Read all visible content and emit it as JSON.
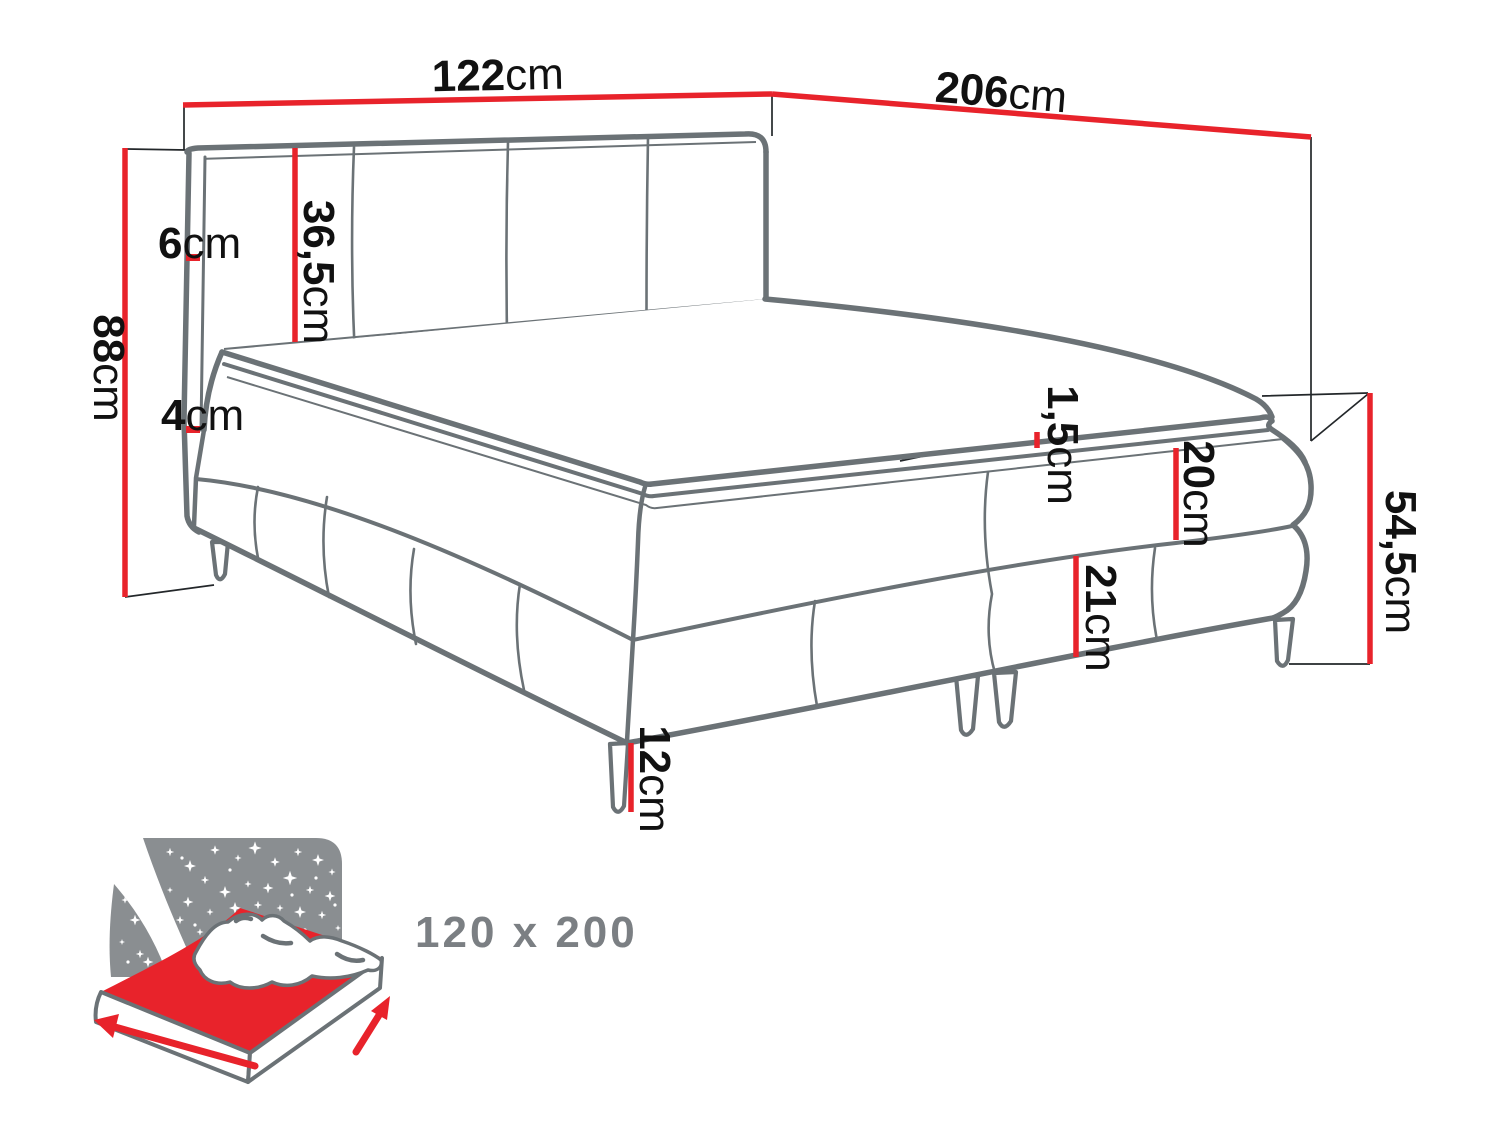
{
  "diagram_title": "boxspring-bed-dimension-diagram",
  "labels": {
    "w122": {
      "num": "122",
      "unit": "cm"
    },
    "l206": {
      "num": "206",
      "unit": "cm"
    },
    "h88": {
      "num": "88",
      "unit": "cm"
    },
    "hb365": {
      "num": "36,5",
      "unit": "cm"
    },
    "e6": {
      "num": "6",
      "unit": "cm"
    },
    "e4": {
      "num": "4",
      "unit": "cm"
    },
    "t15": {
      "num": "1,5",
      "unit": "cm"
    },
    "b20": {
      "num": "20",
      "unit": "cm"
    },
    "b21": {
      "num": "21",
      "unit": "cm"
    },
    "s545": {
      "num": "54,5",
      "unit": "cm"
    },
    "leg12": {
      "num": "12",
      "unit": "cm"
    }
  },
  "icon": {
    "size_caption": "120 x 200"
  },
  "colors": {
    "dimension_red": "#e8232b",
    "outline_gray": "#6b7276",
    "construction_black": "#23272a",
    "icon_gray": "#8a8e91",
    "caption_gray": "#7b7f83",
    "label_black": "#111111",
    "background": "#ffffff"
  }
}
